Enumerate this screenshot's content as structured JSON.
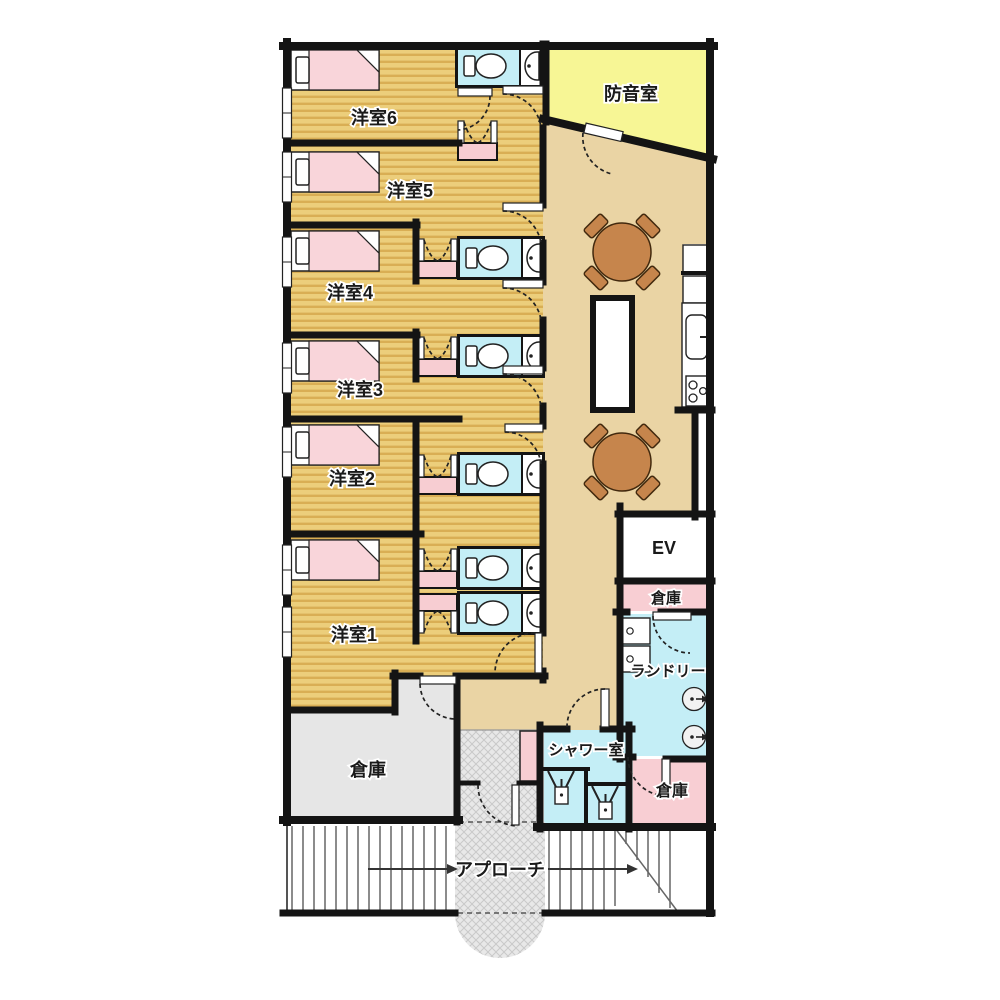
{
  "colors": {
    "wall": "#141414",
    "wood-base": "#ecce7b",
    "wood-stripe": "#d9ae54",
    "corridor": "#ead4a4",
    "toilet-floor": "#c4eef6",
    "soundproof": "#f7f695",
    "bed-pink": "#f9d5da",
    "nook-pink": "#f7cdd2",
    "storage-pink": "#f8ced3",
    "storage-gray": "#e6e6e6",
    "hatch-base": "#e8e8e8",
    "hatch-line": "#c9c9c9",
    "table-brown": "#c6854c",
    "table-stroke": "#42290e",
    "stair-line": "#666666",
    "arrow": "#333333"
  },
  "rooms": {
    "room6": {
      "label": "洋室6"
    },
    "room5": {
      "label": "洋室5"
    },
    "room4": {
      "label": "洋室4"
    },
    "room3": {
      "label": "洋室3"
    },
    "room2": {
      "label": "洋室2"
    },
    "room1": {
      "label": "洋室1"
    },
    "soundproof": {
      "label": "防音室"
    },
    "elevator": {
      "label": "EV"
    },
    "storage_mid": {
      "label": "倉庫"
    },
    "laundry": {
      "label": "ランドリー"
    },
    "shower": {
      "label": "シャワー室"
    },
    "storage_right": {
      "label": "倉庫"
    },
    "storage_left": {
      "label": "倉庫"
    },
    "approach": {
      "label": "アプローチ"
    }
  }
}
